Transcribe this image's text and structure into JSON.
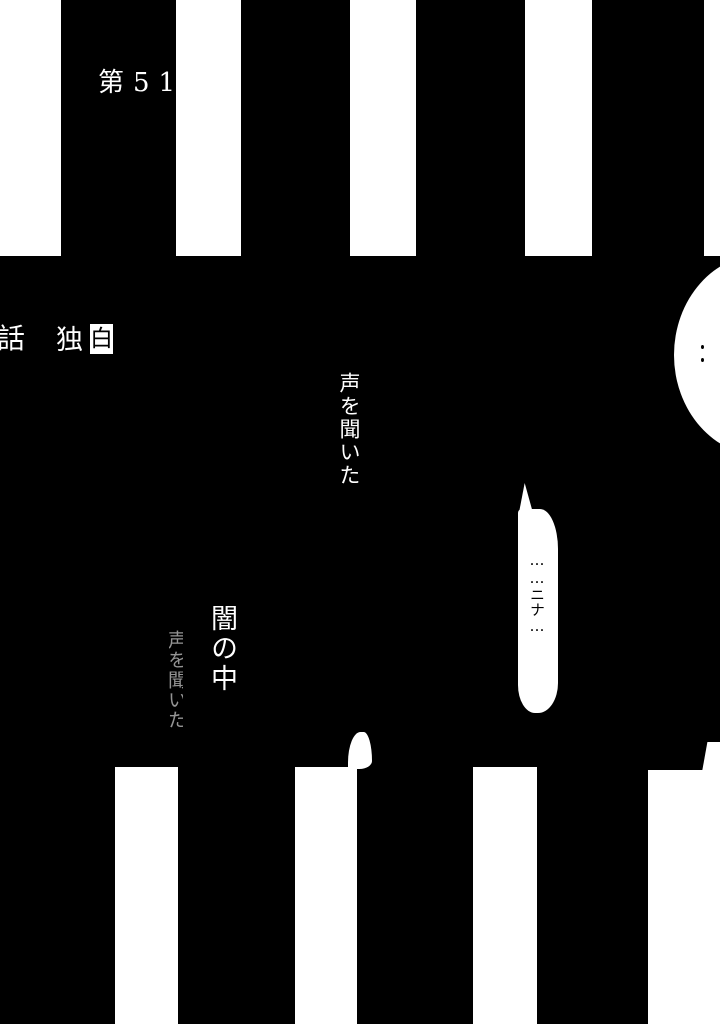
{
  "page": {
    "chapter_label": "第51",
    "chapter_suffix": "話",
    "title_char_1": "独",
    "title_char_2": "白",
    "narration_1": "声を聞いた",
    "narration_2": "闇の中",
    "narration_3": "声を聞いた",
    "speech_bubble": "……ニナ…",
    "colors": {
      "ink": "#000000",
      "paper": "#ffffff",
      "dim_text": "#b9b9b9"
    }
  }
}
